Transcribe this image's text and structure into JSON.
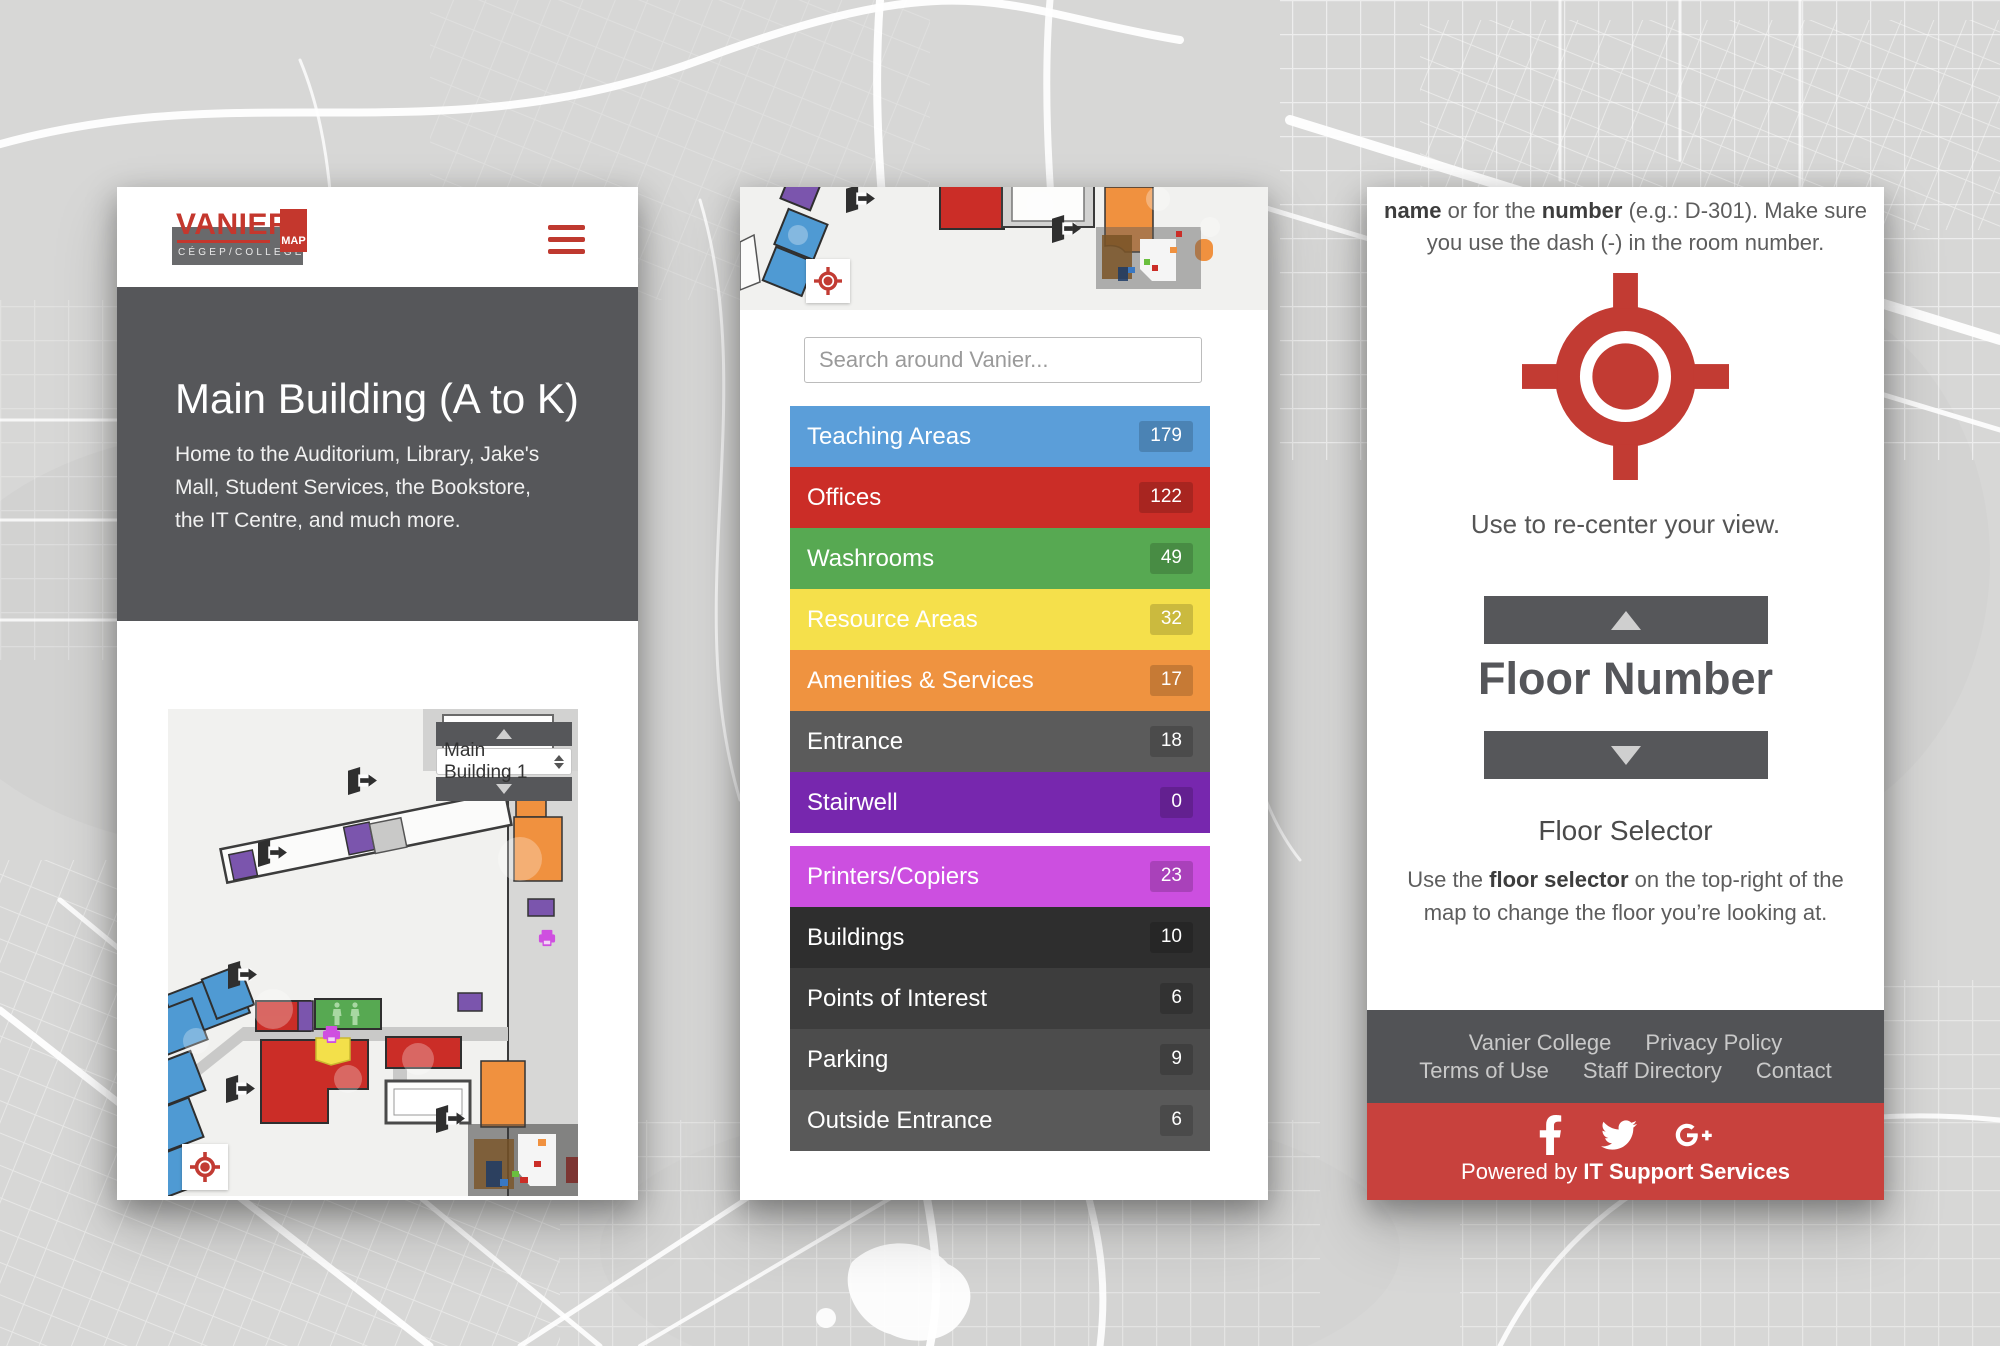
{
  "brand": {
    "name": "VANIER",
    "tagline": "CÉGEP/COLLEGE",
    "map_badge": "MAP"
  },
  "left_panel": {
    "hero": {
      "title": "Main Building (A to K)",
      "description": "Home to the Auditorium, Library, Jake's Mall, Student Services, the Bookstore, the IT Centre, and much more."
    },
    "floor_selector_value": "Main Building 1"
  },
  "middle_panel": {
    "search_placeholder": "Search around Vanier...",
    "categories": [
      {
        "label": "Teaching Areas",
        "count": "179",
        "color": "#5b9ed9"
      },
      {
        "label": "Offices",
        "count": "122",
        "color": "#cb2d27"
      },
      {
        "label": "Washrooms",
        "count": "49",
        "color": "#57a952"
      },
      {
        "label": "Resource Areas",
        "count": "32",
        "color": "#f5e04b"
      },
      {
        "label": "Amenities & Services",
        "count": "17",
        "color": "#ef9340"
      },
      {
        "label": "Entrance",
        "count": "18",
        "color": "#5b5b5b"
      },
      {
        "label": "Stairwell",
        "count": "0",
        "color": "#7727ae"
      },
      {
        "label": "Printers/Copiers",
        "count": "23",
        "color": "#cc4fe0"
      },
      {
        "label": "Buildings",
        "count": "10",
        "color": "#2e2e2e"
      },
      {
        "label": "Points of Interest",
        "count": "6",
        "color": "#3d3d3d"
      },
      {
        "label": "Parking",
        "count": "9",
        "color": "#4c4c4c"
      },
      {
        "label": "Outside Entrance",
        "count": "6",
        "color": "#595959"
      }
    ]
  },
  "right_panel": {
    "search_help": {
      "bold_1": "name",
      "text_1": " or for the ",
      "bold_2": "number",
      "text_2": " (e.g.: D-301). Make sure you use the dash (-) in the room number."
    },
    "recenter_caption": "Use to re-center your view.",
    "floor_number_label": "Floor Number",
    "floor_selector": {
      "heading": "Floor Selector",
      "text_pre": "Use the ",
      "text_bold": "floor selector",
      "text_post": " on the top-right of the map to change the floor you’re looking at."
    },
    "footer": {
      "links": [
        "Vanier College",
        "Privacy Policy",
        "Terms of Use",
        "Staff Directory",
        "Contact"
      ],
      "powered_pre": "Powered by ",
      "powered_bold": "IT Support Services"
    }
  },
  "colors": {
    "brand_red": "#c4372d",
    "dark_gray": "#56575a",
    "footer_red": "#c8413d",
    "target_red": "#c23b33"
  }
}
